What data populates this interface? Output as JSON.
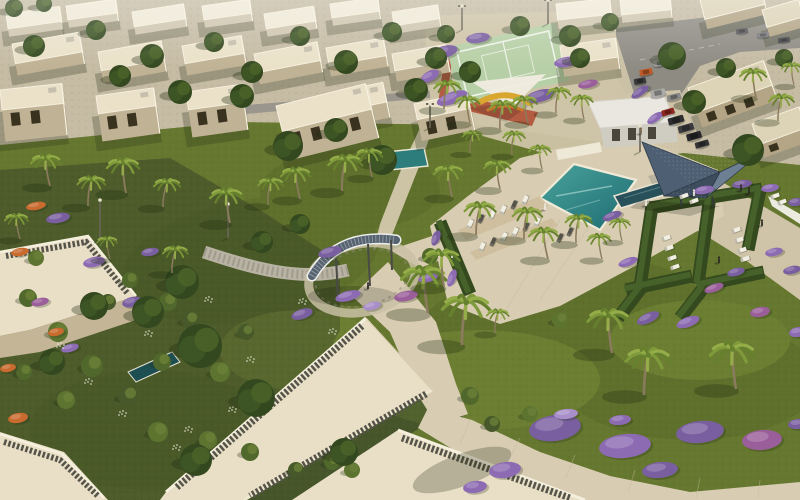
{
  "scene": {
    "description": "Aerial 3D architectural render of a desert villa community: white flat-roofed villas, central landscaped park with curved shade pergola, swimming pools with sun loungers, tennis court, geometric hedge lounge rooms, palm trees, purple bougainvillea and a parking street"
  },
  "palette": {
    "lawn": "#66782f",
    "lawnDark": "#3f4e22",
    "lawnLight": "#8a9c48",
    "gardenShade": "#4d5c2a",
    "gardenShade2": "#46552a",
    "sand": "#d8cdb2",
    "sand2": "#cfc4a8",
    "paver": "#b9b3a4",
    "asphalt": "#8e8b83",
    "roadLight": "#9a958d",
    "roof": "#e9dfc6",
    "parapet": "#f5efdd",
    "pebble": "#55544a",
    "pebbleLight": "#8a887c",
    "wallShade": "#c3b596",
    "hedge": "#35491e",
    "hedgeLight": "#47612a",
    "treeDark": "#33481f",
    "tree": "#3d5525",
    "treeLight": "#4a6328",
    "palm": "#7e9a3a",
    "palmDark": "#66812e",
    "palmLight": "#95ad48",
    "trunk": "#8a7a5e",
    "poolTop": "#49a39b",
    "poolBottom": "#1e6b72",
    "lapPool": "#28505a",
    "spaPool": "#2e7d7d",
    "purple": "#7a5fa0",
    "violet": "#8d6bb3",
    "magenta": "#9a5f9a",
    "lilac": "#a98fc9",
    "orangeFlower": "#c96a2e",
    "canopy1": "#4e5f73",
    "canopy2": "#6c7f93",
    "canopy3": "#3e4d5e",
    "court": "#b7cfa6",
    "courtLine": "#eef3e8",
    "track": "#b2563c",
    "sailWhite": "#f0ece0",
    "sailYellow": "#d9a72f",
    "white": "#f1eee4",
    "dark": "#2e2a26"
  },
  "tones": {
    "roof": [
      "#efe9d6",
      "#eae1c8",
      "#ddd3b6"
    ],
    "wall": [
      "#cfc6ae",
      "#c0b294",
      "#b3a585"
    ],
    "shrub": [
      "#51682c",
      "#5d7431",
      "#47582a"
    ],
    "flower": [
      "#7a5fa0",
      "#8d6bb3",
      "#9a5f9a",
      "#a98fc9",
      "#c96a2e"
    ],
    "lounger": [
      "#f1eee4",
      "#55524a"
    ],
    "person": [
      "#2e2a26",
      "#ece8dc",
      "#7a6a52"
    ]
  },
  "villas": [
    [
      6,
      14,
      54,
      15,
      8,
      -8,
      0,
      0
    ],
    [
      66,
      6,
      50,
      14,
      8,
      -8,
      0,
      0
    ],
    [
      132,
      12,
      52,
      15,
      8,
      -9,
      0,
      0
    ],
    [
      202,
      6,
      48,
      14,
      8,
      -8,
      0,
      0
    ],
    [
      264,
      14,
      50,
      15,
      8,
      -9,
      0,
      0
    ],
    [
      330,
      4,
      48,
      14,
      8,
      -8,
      0,
      0
    ],
    [
      392,
      12,
      46,
      14,
      8,
      -9,
      0,
      0
    ],
    [
      556,
      4,
      54,
      16,
      9,
      -6,
      0,
      0
    ],
    [
      620,
      0,
      50,
      15,
      8,
      -6,
      0,
      0
    ],
    [
      700,
      0,
      62,
      20,
      10,
      -14,
      2,
      0
    ],
    [
      762,
      10,
      38,
      18,
      10,
      -16,
      2,
      0
    ],
    [
      12,
      44,
      68,
      20,
      12,
      -10,
      1,
      0
    ],
    [
      98,
      52,
      64,
      19,
      12,
      -10,
      1,
      0
    ],
    [
      182,
      46,
      60,
      18,
      12,
      -10,
      1,
      0
    ],
    [
      254,
      54,
      64,
      19,
      12,
      -11,
      1,
      0
    ],
    [
      326,
      48,
      58,
      18,
      11,
      -10,
      1,
      0
    ],
    [
      392,
      54,
      54,
      17,
      11,
      -10,
      1,
      0
    ],
    [
      560,
      46,
      56,
      19,
      12,
      -8,
      1,
      0
    ],
    [
      318,
      96,
      66,
      20,
      16,
      -12,
      1,
      1
    ],
    [
      276,
      106,
      92,
      26,
      30,
      -14,
      1,
      1
    ],
    [
      0,
      90,
      62,
      20,
      32,
      -6,
      1,
      1
    ],
    [
      96,
      96,
      58,
      18,
      28,
      -8,
      1,
      1
    ],
    [
      186,
      92,
      56,
      18,
      28,
      -8,
      1,
      1
    ],
    [
      414,
      104,
      54,
      16,
      22,
      -12,
      1,
      1
    ],
    [
      688,
      88,
      80,
      26,
      16,
      -20,
      2,
      1
    ],
    [
      752,
      124,
      50,
      22,
      14,
      -20,
      2,
      1
    ]
  ],
  "palms": [
    [
      50,
      185,
      1,
      -6
    ],
    [
      88,
      205,
      0.95,
      5
    ],
    [
      126,
      192,
      1.1,
      -4
    ],
    [
      163,
      206,
      0.9,
      6
    ],
    [
      230,
      222,
      1.1,
      -5
    ],
    [
      268,
      204,
      0.85,
      4
    ],
    [
      300,
      198,
      1,
      -6
    ],
    [
      342,
      190,
      1.15,
      5
    ],
    [
      372,
      176,
      0.9,
      -4
    ],
    [
      20,
      238,
      0.8,
      -5
    ],
    [
      110,
      258,
      0.7,
      -4
    ],
    [
      172,
      272,
      0.85,
      5
    ],
    [
      452,
      196,
      1,
      -5
    ],
    [
      476,
      234,
      1.05,
      6
    ],
    [
      500,
      188,
      0.9,
      -4
    ],
    [
      524,
      238,
      1,
      5
    ],
    [
      548,
      258,
      1,
      -6
    ],
    [
      576,
      242,
      0.9,
      4
    ],
    [
      602,
      258,
      0.8,
      -4
    ],
    [
      512,
      154,
      0.75,
      3
    ],
    [
      542,
      168,
      0.75,
      -3
    ],
    [
      470,
      152,
      0.7,
      4
    ],
    [
      622,
      240,
      0.7,
      -3
    ],
    [
      444,
      108,
      0.9,
      5
    ],
    [
      470,
      122,
      0.85,
      -4
    ],
    [
      500,
      128,
      0.9,
      4
    ],
    [
      528,
      122,
      0.85,
      -5
    ],
    [
      556,
      112,
      0.8,
      4
    ],
    [
      584,
      118,
      0.75,
      -3
    ],
    [
      428,
      312,
      1.5,
      -6
    ],
    [
      462,
      344,
      1.6,
      6
    ],
    [
      444,
      286,
      1.2,
      -3
    ],
    [
      495,
      332,
      0.75,
      4
    ],
    [
      612,
      352,
      1.4,
      -5
    ],
    [
      644,
      394,
      1.5,
      6
    ],
    [
      736,
      388,
      1.5,
      -5
    ],
    [
      756,
      96,
      0.9,
      -4
    ],
    [
      778,
      120,
      0.85,
      5
    ],
    [
      794,
      84,
      0.7,
      -3
    ]
  ],
  "trees": [
    [
      34,
      46,
      11
    ],
    [
      96,
      30,
      10
    ],
    [
      152,
      56,
      12
    ],
    [
      214,
      42,
      10
    ],
    [
      252,
      72,
      11
    ],
    [
      300,
      36,
      10
    ],
    [
      346,
      62,
      12
    ],
    [
      392,
      32,
      10
    ],
    [
      436,
      58,
      11
    ],
    [
      520,
      26,
      10
    ],
    [
      570,
      36,
      11
    ],
    [
      610,
      22,
      9
    ],
    [
      120,
      76,
      11
    ],
    [
      180,
      92,
      12
    ],
    [
      242,
      96,
      12
    ],
    [
      288,
      146,
      15
    ],
    [
      336,
      130,
      12
    ],
    [
      382,
      160,
      15
    ],
    [
      416,
      90,
      12
    ],
    [
      470,
      72,
      11
    ],
    [
      672,
      56,
      14
    ],
    [
      694,
      102,
      12
    ],
    [
      748,
      150,
      16
    ],
    [
      726,
      68,
      10
    ],
    [
      784,
      58,
      9
    ],
    [
      446,
      34,
      9
    ],
    [
      580,
      58,
      10
    ],
    [
      200,
      346,
      22
    ],
    [
      256,
      398,
      19
    ],
    [
      148,
      312,
      16
    ],
    [
      94,
      306,
      14
    ],
    [
      182,
      282,
      17
    ],
    [
      52,
      362,
      13
    ],
    [
      196,
      460,
      16
    ],
    [
      344,
      452,
      14
    ],
    [
      262,
      242,
      11
    ],
    [
      300,
      224,
      10
    ],
    [
      14,
      8,
      9
    ],
    [
      44,
      4,
      8
    ]
  ],
  "shrubs": [
    [
      28,
      298,
      9,
      0
    ],
    [
      58,
      332,
      10,
      1
    ],
    [
      92,
      366,
      11,
      0
    ],
    [
      128,
      396,
      10,
      2
    ],
    [
      66,
      400,
      9,
      1
    ],
    [
      24,
      372,
      8,
      0
    ],
    [
      158,
      432,
      10,
      1
    ],
    [
      108,
      302,
      8,
      2
    ],
    [
      168,
      302,
      9,
      0
    ],
    [
      208,
      440,
      9,
      1
    ],
    [
      250,
      452,
      9,
      0
    ],
    [
      296,
      470,
      8,
      2
    ],
    [
      36,
      258,
      8,
      1
    ],
    [
      130,
      280,
      8,
      0
    ],
    [
      190,
      320,
      9,
      2
    ],
    [
      220,
      372,
      10,
      1
    ],
    [
      162,
      362,
      9,
      0
    ],
    [
      246,
      332,
      8,
      2
    ],
    [
      262,
      402,
      9,
      1
    ],
    [
      332,
      462,
      8,
      0
    ],
    [
      352,
      470,
      8,
      1
    ],
    [
      470,
      396,
      9,
      0
    ],
    [
      492,
      424,
      8,
      2
    ],
    [
      530,
      414,
      8,
      1
    ],
    [
      430,
      256,
      8,
      0
    ],
    [
      560,
      320,
      8,
      1
    ]
  ],
  "flowers": [
    [
      444,
      52,
      14,
      6,
      -15,
      0
    ],
    [
      452,
      98,
      16,
      6,
      -20,
      1
    ],
    [
      540,
      96,
      15,
      6,
      -15,
      0
    ],
    [
      566,
      62,
      12,
      5,
      -10,
      1
    ],
    [
      478,
      38,
      12,
      5,
      -8,
      0
    ],
    [
      588,
      84,
      10,
      4,
      -12,
      2
    ],
    [
      430,
      76,
      10,
      5,
      -30,
      1
    ],
    [
      640,
      92,
      10,
      4,
      -35,
      0
    ],
    [
      655,
      118,
      9,
      4,
      -35,
      1
    ],
    [
      330,
      252,
      12,
      5,
      -15,
      0
    ],
    [
      348,
      296,
      13,
      5,
      -15,
      1
    ],
    [
      406,
      296,
      12,
      5,
      -12,
      2
    ],
    [
      302,
      314,
      11,
      5,
      -18,
      0
    ],
    [
      428,
      278,
      10,
      4,
      -12,
      1
    ],
    [
      372,
      306,
      9,
      4,
      -14,
      3
    ],
    [
      555,
      428,
      26,
      13,
      -8,
      0
    ],
    [
      625,
      446,
      26,
      12,
      -6,
      1
    ],
    [
      700,
      432,
      24,
      11,
      -6,
      0
    ],
    [
      762,
      440,
      20,
      10,
      -5,
      2
    ],
    [
      505,
      470,
      16,
      8,
      -8,
      1
    ],
    [
      660,
      470,
      18,
      8,
      -6,
      0
    ],
    [
      475,
      487,
      12,
      6,
      -8,
      1
    ],
    [
      798,
      424,
      10,
      5,
      -5,
      0
    ],
    [
      566,
      414,
      12,
      5,
      -6,
      3
    ],
    [
      620,
      420,
      11,
      5,
      -6,
      1
    ],
    [
      612,
      216,
      10,
      4,
      -20,
      0
    ],
    [
      628,
      262,
      10,
      4,
      -20,
      1
    ],
    [
      648,
      318,
      12,
      5,
      -25,
      0
    ],
    [
      688,
      322,
      12,
      5,
      -20,
      1
    ],
    [
      714,
      288,
      10,
      4,
      -20,
      2
    ],
    [
      736,
      272,
      9,
      4,
      -15,
      0
    ],
    [
      704,
      190,
      10,
      4,
      -10,
      1
    ],
    [
      742,
      184,
      10,
      4,
      -8,
      0
    ],
    [
      770,
      188,
      9,
      4,
      -8,
      1
    ],
    [
      796,
      202,
      8,
      4,
      -8,
      0
    ],
    [
      774,
      252,
      9,
      4,
      -12,
      1
    ],
    [
      792,
      270,
      9,
      4,
      -12,
      0
    ],
    [
      760,
      312,
      10,
      5,
      -10,
      2
    ],
    [
      798,
      332,
      9,
      5,
      -10,
      1
    ],
    [
      436,
      238,
      8,
      4,
      -70,
      0
    ],
    [
      452,
      278,
      9,
      4,
      -70,
      1
    ],
    [
      58,
      218,
      12,
      5,
      -10,
      0
    ],
    [
      94,
      262,
      11,
      5,
      -12,
      1
    ],
    [
      132,
      302,
      10,
      5,
      -14,
      0
    ],
    [
      40,
      302,
      9,
      4,
      -12,
      2
    ],
    [
      20,
      252,
      9,
      4,
      -10,
      4
    ],
    [
      56,
      332,
      8,
      4,
      -12,
      4
    ],
    [
      36,
      206,
      10,
      4,
      -10,
      4
    ],
    [
      70,
      348,
      9,
      4,
      -15,
      1
    ],
    [
      150,
      252,
      9,
      4,
      -10,
      0
    ],
    [
      18,
      418,
      10,
      5,
      -10,
      4
    ],
    [
      8,
      368,
      8,
      4,
      -10,
      4
    ]
  ],
  "sparkles": [
    [
      60,
      346
    ],
    [
      88,
      382
    ],
    [
      122,
      414
    ],
    [
      148,
      334
    ],
    [
      196,
      362
    ],
    [
      232,
      410
    ],
    [
      176,
      448
    ],
    [
      208,
      300
    ],
    [
      188,
      430
    ],
    [
      250,
      360
    ],
    [
      302,
      302
    ],
    [
      332,
      332
    ]
  ],
  "loungers": [
    [
      470,
      224,
      -65,
      0
    ],
    [
      481,
      219,
      -65,
      1
    ],
    [
      492,
      215,
      -65,
      0
    ],
    [
      503,
      210,
      -65,
      0
    ],
    [
      514,
      205,
      -65,
      1
    ],
    [
      525,
      200,
      -65,
      0
    ],
    [
      482,
      247,
      -65,
      0
    ],
    [
      493,
      242,
      -65,
      1
    ],
    [
      504,
      237,
      -65,
      0
    ],
    [
      515,
      232,
      -65,
      0
    ],
    [
      526,
      227,
      -65,
      1
    ],
    [
      537,
      222,
      -65,
      0
    ],
    [
      560,
      238,
      -65,
      1
    ],
    [
      570,
      232,
      -65,
      1
    ],
    [
      684,
      196,
      -20,
      0
    ],
    [
      694,
      201,
      -20,
      0
    ],
    [
      666,
      238,
      -20,
      0
    ],
    [
      669,
      248,
      -20,
      0
    ],
    [
      672,
      258,
      -20,
      0
    ],
    [
      675,
      267,
      -20,
      0
    ],
    [
      736,
      230,
      -20,
      0
    ],
    [
      739,
      240,
      -20,
      0
    ],
    [
      742,
      250,
      -20,
      0
    ],
    [
      745,
      259,
      -20,
      0
    ],
    [
      775,
      196,
      -20,
      0
    ],
    [
      782,
      202,
      -20,
      0
    ]
  ],
  "cars": [
    [
      660,
      63,
      13,
      6,
      -10,
      "#9c9c9a"
    ],
    [
      646,
      72,
      13,
      6,
      -10,
      "#c05a28"
    ],
    [
      640,
      81,
      12,
      6,
      -10,
      "#3a3a3c"
    ],
    [
      658,
      93,
      15,
      7,
      -12,
      "#aaaaa8"
    ],
    [
      674,
      97,
      14,
      6,
      -12,
      "#8a8a88"
    ],
    [
      668,
      112,
      13,
      6,
      -16,
      "#8e2820"
    ],
    [
      676,
      120,
      16,
      7,
      -16,
      "#2e2e30"
    ],
    [
      686,
      128,
      16,
      7,
      -16,
      "#3c3c40"
    ],
    [
      694,
      136,
      15,
      7,
      -16,
      "#26262a"
    ],
    [
      702,
      144,
      14,
      6,
      -16,
      "#333336"
    ],
    [
      742,
      31,
      12,
      5,
      -6,
      "#56565a"
    ],
    [
      763,
      35,
      12,
      5,
      -6,
      "#7a7a7e"
    ],
    [
      784,
      40,
      12,
      5,
      -6,
      "#46464a"
    ]
  ],
  "people": [
    [
      368,
      289,
      0
    ],
    [
      646,
      206,
      1
    ],
    [
      694,
      196,
      1
    ],
    [
      741,
      191,
      0
    ],
    [
      749,
      194,
      0
    ],
    [
      719,
      263,
      0
    ],
    [
      762,
      226,
      0
    ],
    [
      641,
      134,
      2
    ],
    [
      545,
      210,
      1
    ],
    [
      452,
      258,
      1
    ]
  ],
  "lamps": [
    [
      100,
      240,
      40
    ],
    [
      228,
      238,
      34
    ],
    [
      430,
      128,
      24
    ],
    [
      640,
      152,
      26
    ],
    [
      462,
      30,
      24
    ],
    [
      548,
      24,
      24
    ]
  ]
}
